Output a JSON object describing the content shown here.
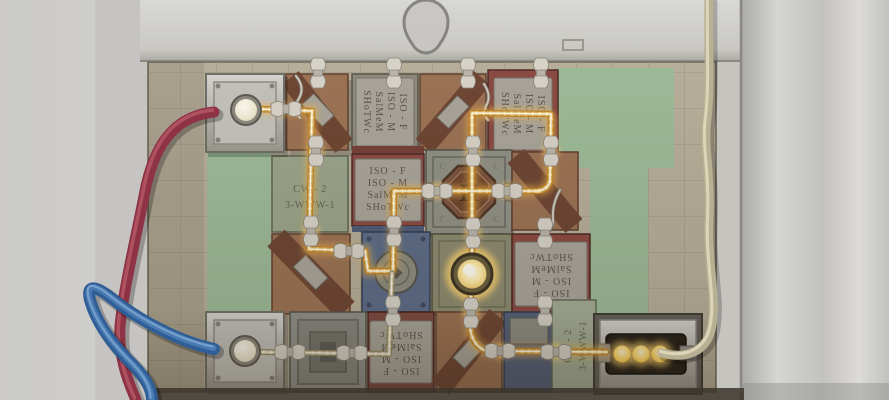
{
  "tiles": {
    "iso_plate": {
      "lines": [
        "ISO - F",
        "ISO - M",
        "SalMeM",
        "SHoTWc"
      ]
    },
    "cw_plate": {
      "title": "CW - 2",
      "schematic": "3-WWW-1"
    },
    "h_tile": {
      "emblem": "H",
      "corner_mark": "C"
    }
  },
  "output_socket": {
    "indicator_dots": 3
  },
  "colors": {
    "powered_wire": "#ffdf96",
    "powered_core": "#fffbe4",
    "wire_shadow": "#c2872e",
    "unpowered_wire": "#e4dcc2",
    "glow": "#ffd470",
    "red_cable": "#8e3346",
    "blue_cable": "#3f6fa8",
    "beige_cable": "#c3bb9c",
    "board": "#b6ae99",
    "green_patch": "#9cba97",
    "panel_metal": "#c6c4bf",
    "bulb": "#f3efdd"
  }
}
